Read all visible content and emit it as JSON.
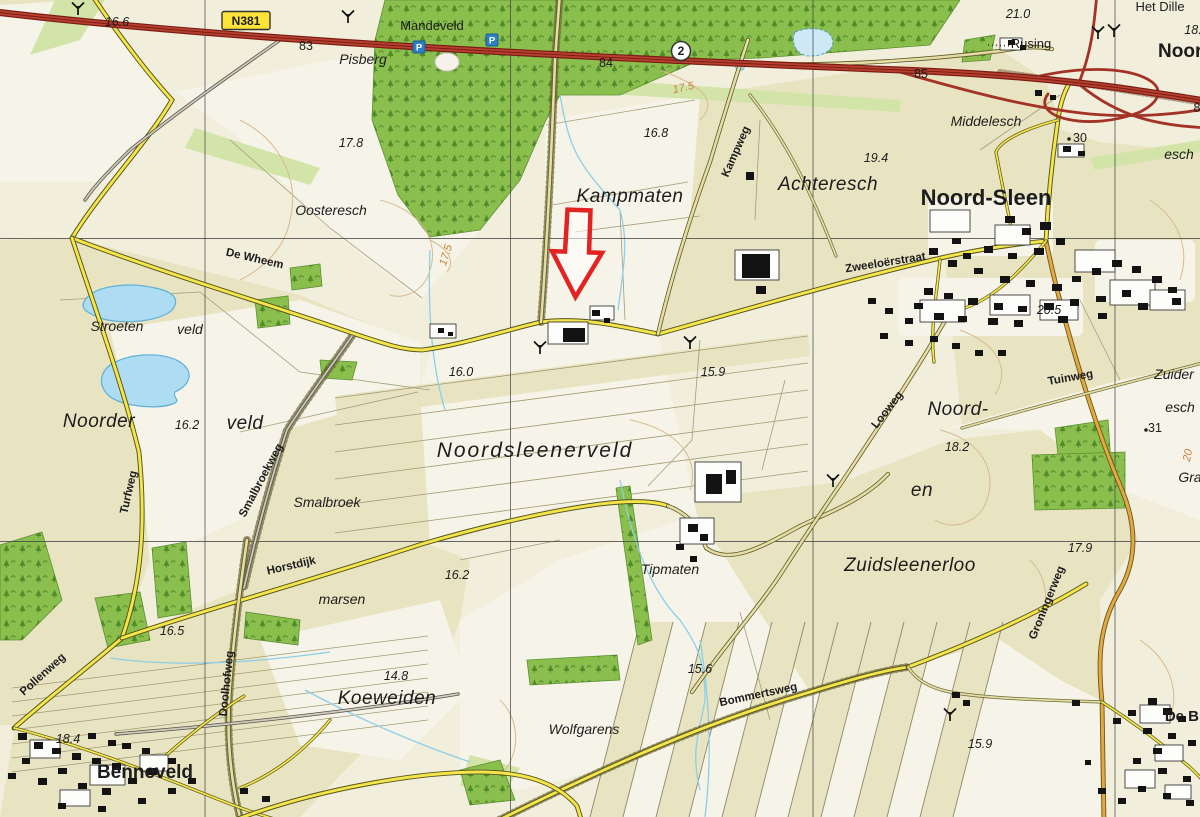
{
  "map": {
    "colors": {
      "field_beige": "#e8e4c2",
      "field_light": "#f6f4e8",
      "forest_green": "#8abf4d",
      "pale_green": "#d2e4a8",
      "water_blue": "#aedcf2",
      "road_yellow": "#f4e54a",
      "road_orange": "#e2a93e",
      "motorway_red": "#b8402f",
      "arrow_red": "#e32222",
      "contour_orange": "#c9803a"
    },
    "grid": {
      "vertical_x": [
        205,
        510.5,
        813,
        1115
      ],
      "horizontal_y": [
        238.5,
        541.5
      ]
    },
    "badges": [
      {
        "type": "box",
        "label": "N381",
        "x": 246,
        "y": 21
      },
      {
        "type": "circle",
        "label": "2",
        "x": 681,
        "y": 51
      }
    ],
    "icons": [
      {
        "name": "parking-icon",
        "label": "P",
        "x": 419,
        "y": 47
      },
      {
        "name": "parking-icon",
        "label": "P",
        "x": 492,
        "y": 40
      }
    ],
    "arrow": {
      "color": "#e32222",
      "tip_x": 577,
      "tip_y": 297
    },
    "labels": [
      {
        "text": "16.6",
        "x": 117,
        "y": 26,
        "cls": "elev"
      },
      {
        "text": "83",
        "x": 306,
        "y": 50,
        "cls": "num"
      },
      {
        "text": "Mandeveld",
        "x": 432,
        "y": 30,
        "cls": "place"
      },
      {
        "text": "Pisberg",
        "x": 363,
        "y": 64,
        "cls": "area"
      },
      {
        "text": "84",
        "x": 606,
        "y": 67,
        "cls": "num"
      },
      {
        "text": "17.5",
        "x": 684,
        "y": 91,
        "cls": "contour",
        "rot": -12
      },
      {
        "text": "21.0",
        "x": 1018,
        "y": 18,
        "cls": "elev"
      },
      {
        "text": "Rusing",
        "x": 1031,
        "y": 48,
        "cls": "place"
      },
      {
        "text": "Het Dille",
        "x": 1160,
        "y": 11,
        "cls": "place"
      },
      {
        "text": "18.",
        "x": 1193,
        "y": 34,
        "cls": "elev"
      },
      {
        "text": "Noord",
        "x": 1186,
        "y": 57,
        "cls": "town-lg"
      },
      {
        "text": "85",
        "x": 921,
        "y": 78,
        "cls": "num"
      },
      {
        "text": "8",
        "x": 1197,
        "y": 112,
        "cls": "num"
      },
      {
        "text": "Middelesch",
        "x": 986,
        "y": 126,
        "cls": "area"
      },
      {
        "text": "17.8",
        "x": 351,
        "y": 147,
        "cls": "elev"
      },
      {
        "text": "16.8",
        "x": 656,
        "y": 137,
        "cls": "elev"
      },
      {
        "text": "19.4",
        "x": 876,
        "y": 162,
        "cls": "elev"
      },
      {
        "text": "30",
        "x": 1080,
        "y": 142,
        "cls": "num"
      },
      {
        "text": "esch",
        "x": 1179,
        "y": 159,
        "cls": "area"
      },
      {
        "text": "Kampweg",
        "x": 739,
        "y": 153,
        "cls": "road",
        "rot": -66
      },
      {
        "text": "Achteresch",
        "x": 828,
        "y": 190,
        "cls": "area-lg"
      },
      {
        "text": "Noord-Sleen",
        "x": 986,
        "y": 205,
        "cls": "town-xl"
      },
      {
        "text": "Kampmaten",
        "x": 630,
        "y": 202,
        "cls": "area-lg"
      },
      {
        "text": "Oosteresch",
        "x": 331,
        "y": 215,
        "cls": "area"
      },
      {
        "text": "De Wheem",
        "x": 254,
        "y": 262,
        "cls": "road",
        "rot": 13
      },
      {
        "text": "Zweeloërstraat",
        "x": 886,
        "y": 266,
        "cls": "road",
        "rot": -9
      },
      {
        "text": "17.5",
        "x": 449,
        "y": 256,
        "cls": "contour",
        "rot": -72
      },
      {
        "text": "20.5",
        "x": 1049,
        "y": 314,
        "cls": "elev"
      },
      {
        "text": "Stroeten",
        "x": 117,
        "y": 331,
        "cls": "area"
      },
      {
        "text": "veld",
        "x": 190,
        "y": 334,
        "cls": "area"
      },
      {
        "text": "16.0",
        "x": 461,
        "y": 376,
        "cls": "elev"
      },
      {
        "text": "15.9",
        "x": 713,
        "y": 376,
        "cls": "elev"
      },
      {
        "text": "Noorder",
        "x": 99,
        "y": 427,
        "cls": "area-lg"
      },
      {
        "text": "16.2",
        "x": 187,
        "y": 429,
        "cls": "elev"
      },
      {
        "text": "veld",
        "x": 245,
        "y": 429,
        "cls": "area-lg"
      },
      {
        "text": "Noord-",
        "x": 958,
        "y": 415,
        "cls": "area-lg"
      },
      {
        "text": "18.2",
        "x": 957,
        "y": 451,
        "cls": "elev"
      },
      {
        "text": "en",
        "x": 922,
        "y": 496,
        "cls": "area-lg"
      },
      {
        "text": "Looweg",
        "x": 890,
        "y": 412,
        "cls": "road",
        "rot": -52
      },
      {
        "text": "Tuinweg",
        "x": 1071,
        "y": 381,
        "cls": "road",
        "rot": -10
      },
      {
        "text": "Zuider",
        "x": 1174,
        "y": 379,
        "cls": "area"
      },
      {
        "text": "esch",
        "x": 1180,
        "y": 412,
        "cls": "area"
      },
      {
        "text": "31",
        "x": 1155,
        "y": 432,
        "cls": "num"
      },
      {
        "text": "20",
        "x": 1191,
        "y": 456,
        "cls": "contour",
        "rot": -78
      },
      {
        "text": "Gra",
        "x": 1190,
        "y": 482,
        "cls": "area"
      },
      {
        "text": "Turfweg",
        "x": 132,
        "y": 493,
        "cls": "road",
        "rot": -77
      },
      {
        "text": "Smalbroekweg",
        "x": 264,
        "y": 482,
        "cls": "road",
        "rot": -62
      },
      {
        "text": "Smalbroek",
        "x": 327,
        "y": 507,
        "cls": "area"
      },
      {
        "text": "Noordsleenerveld",
        "x": 535,
        "y": 457,
        "cls": "area-xl"
      },
      {
        "text": "Horstdijk",
        "x": 292,
        "y": 569,
        "cls": "road",
        "rot": -13
      },
      {
        "text": "marsen",
        "x": 342,
        "y": 604,
        "cls": "area"
      },
      {
        "text": "16.2",
        "x": 457,
        "y": 579,
        "cls": "elev"
      },
      {
        "text": "Tipmaten",
        "x": 670,
        "y": 574,
        "cls": "area"
      },
      {
        "text": "Zuidsleenerloo",
        "x": 910,
        "y": 571,
        "cls": "area-lg"
      },
      {
        "text": "17.9",
        "x": 1080,
        "y": 552,
        "cls": "elev"
      },
      {
        "text": "Groningerweg",
        "x": 1050,
        "y": 604,
        "cls": "road",
        "rot": -68
      },
      {
        "text": "16.5",
        "x": 172,
        "y": 635,
        "cls": "elev"
      },
      {
        "text": "Pollenweg",
        "x": 45,
        "y": 677,
        "cls": "road",
        "rot": -42
      },
      {
        "text": "Doolhofweg",
        "x": 230,
        "y": 684,
        "cls": "road",
        "rot": -84
      },
      {
        "text": "14.8",
        "x": 396,
        "y": 680,
        "cls": "elev"
      },
      {
        "text": "Koeweiden",
        "x": 387,
        "y": 704,
        "cls": "area-lg"
      },
      {
        "text": "15.6",
        "x": 700,
        "y": 673,
        "cls": "elev"
      },
      {
        "text": "Bommertsweg",
        "x": 759,
        "y": 698,
        "cls": "road",
        "rot": -12
      },
      {
        "text": "Wolfgarens",
        "x": 584,
        "y": 734,
        "cls": "area"
      },
      {
        "text": "18.4",
        "x": 68,
        "y": 743,
        "cls": "elev"
      },
      {
        "text": "Benneveld",
        "x": 145,
        "y": 778,
        "cls": "town-lg"
      },
      {
        "text": "15.9",
        "x": 980,
        "y": 748,
        "cls": "elev"
      },
      {
        "text": "De Bl",
        "x": 1184,
        "y": 721,
        "cls": "town"
      }
    ]
  }
}
